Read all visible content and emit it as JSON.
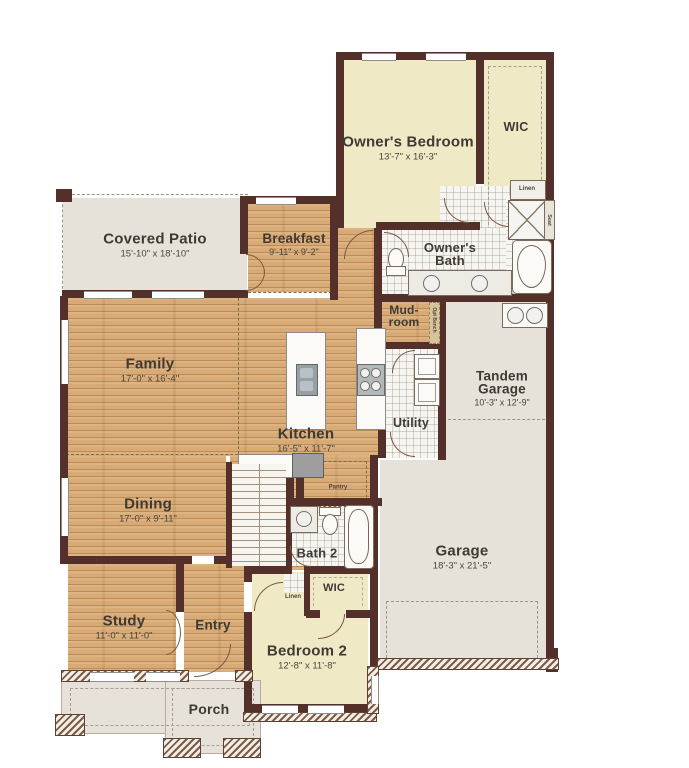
{
  "plan": {
    "rooms": {
      "owners_bedroom": {
        "name": "Owner's Bedroom",
        "dims": "13'-7\" x 16'-3\""
      },
      "wic_owner": {
        "name": "WIC"
      },
      "linen_owner": {
        "name": "Linen"
      },
      "seat": {
        "name": "Seat"
      },
      "owners_bath": {
        "line1": "Owner's",
        "line2": "Bath"
      },
      "covered_patio": {
        "name": "Covered Patio",
        "dims": "15'-10\" x 18'-10\""
      },
      "breakfast": {
        "name": "Breakfast",
        "dims": "9'-11\" x 9'-2\""
      },
      "mud_room": {
        "line1": "Mud-",
        "line2": "room"
      },
      "opt_bench": {
        "name": "Opt Bench"
      },
      "family": {
        "name": "Family",
        "dims": "17'-0\" x 16'-4\""
      },
      "kitchen": {
        "name": "Kitchen",
        "dims": "16'-5\" x 11'-7\""
      },
      "utility": {
        "name": "Utility"
      },
      "tandem_garage": {
        "line1": "Tandem",
        "line2": "Garage",
        "dims": "10'-3\" x 12'-9\""
      },
      "dining": {
        "name": "Dining",
        "dims": "17'-0\" x 9'-11\""
      },
      "pantry": {
        "name": "Pantry"
      },
      "bath_2": {
        "name": "Bath 2"
      },
      "wic_2": {
        "name": "WIC"
      },
      "linen_2": {
        "name": "Linen"
      },
      "garage": {
        "name": "Garage",
        "dims": "18'-3\" x 21'-5\""
      },
      "study": {
        "name": "Study",
        "dims": "11'-0\" x 11'-0\""
      },
      "entry": {
        "name": "Entry"
      },
      "bedroom_2": {
        "name": "Bedroom 2",
        "dims": "12'-8\" x 11'-8\""
      },
      "porch": {
        "name": "Porch"
      }
    },
    "colors": {
      "wall": "#53312a",
      "wood_floor": "#d8ab76",
      "bedroom_floor": "#f0e9c6",
      "concrete_floor": "#e6e1d9",
      "tile_floor": "#f6f5f1",
      "label_text": "#3f3a33"
    }
  }
}
